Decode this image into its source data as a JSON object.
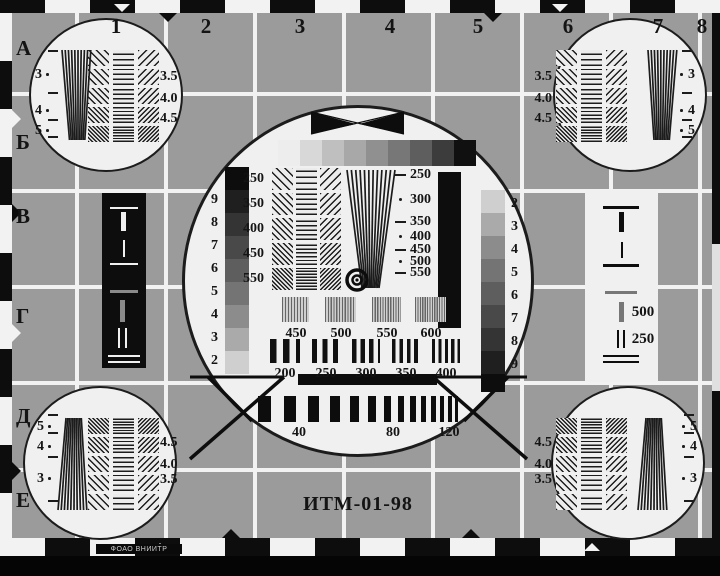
{
  "title": "ИТМ-01-98",
  "imprint": "ФОАО ВНИИТР",
  "grid": {
    "column_labels": [
      "1",
      "2",
      "3",
      "4",
      "5",
      "6",
      "7",
      "8"
    ],
    "row_labels": [
      "А",
      "Б",
      "В",
      "Г",
      "Д",
      "Е"
    ]
  },
  "corner_circles": {
    "wedge_labels": [
      "3",
      "4",
      "5"
    ],
    "grating_labels": [
      "3.5",
      "4.0",
      "4.5"
    ]
  },
  "center_circle": {
    "left_staircase_labels": [
      "9",
      "8",
      "7",
      "6",
      "5",
      "4",
      "3",
      "2"
    ],
    "right_staircase_labels": [
      "2",
      "3",
      "4",
      "5",
      "6",
      "7",
      "8",
      "9"
    ],
    "left_grating_labels": [
      "250",
      "350",
      "400",
      "450",
      "550"
    ],
    "wedge_scale_labels": [
      "250",
      "300",
      "350",
      "400",
      "450",
      "500",
      "550"
    ],
    "top_grating_labels": [
      "450",
      "500",
      "550",
      "600"
    ],
    "bottom_grating_labels": [
      "200",
      "250",
      "300",
      "350",
      "400"
    ],
    "pulse_width_labels": [
      "40",
      "80",
      "120"
    ]
  },
  "right_bar_labels": {
    "bar_label": "500",
    "double_line_label": "250"
  },
  "colors": {
    "background": "#9b9b9b",
    "panel_white": "#f0f0f0",
    "ink_black": "#0d0d0d",
    "grid_line": "#f2f2f2",
    "mid_gray": "#8a8a8a",
    "text": "#141414"
  },
  "grayscale_strip_shades": [
    "#ededed",
    "#d8d8d8",
    "#bfbfbf",
    "#a8a8a8",
    "#909090",
    "#777777",
    "#5e5e5e",
    "#3c3c3c",
    "#101010"
  ],
  "staircase_shades": [
    "#0d0d0d",
    "#1f1f1f",
    "#343434",
    "#494949",
    "#5e5e5e",
    "#747474",
    "#8c8c8c",
    "#aaaaaa",
    "#cfcfcf"
  ]
}
